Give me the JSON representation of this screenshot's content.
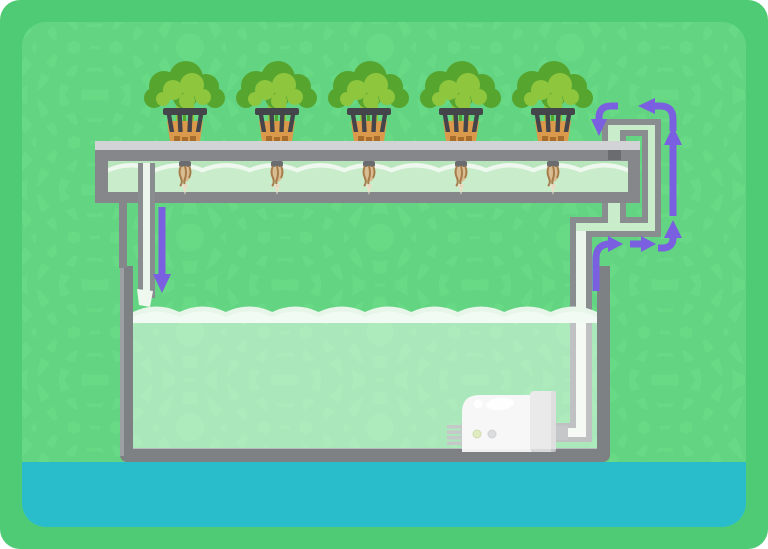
{
  "diagram": {
    "kind": "hydroponics-recirculating-system",
    "plant_count": 5,
    "components": [
      "grow-channel-with-plants",
      "net-pot-plants",
      "channel-drain-pipe",
      "reservoir-tank",
      "tank-nutrient-water",
      "water-pump",
      "pump-riser-pipe",
      "return-pipe-network",
      "channel-outlet-downspout",
      "ground-water-strip"
    ],
    "flow_arrows": [
      {
        "id": "drain-into-tank",
        "direction": "down"
      },
      {
        "id": "out-of-pump",
        "direction": "up-then-right"
      },
      {
        "id": "along-return-pipe",
        "direction": "right"
      },
      {
        "id": "into-riser",
        "direction": "right-then-up"
      },
      {
        "id": "up-riser",
        "direction": "up"
      },
      {
        "id": "over-the-top",
        "direction": "up-then-left"
      },
      {
        "id": "into-channel",
        "direction": "left-then-down"
      }
    ]
  },
  "colors": {
    "frame_green": "#4ecb74",
    "panel_green": "#68da85",
    "pattern_green": "#5ed07e",
    "ground_teal": "#29bcca",
    "tank_gray": "#7e8184",
    "tank_gray_light": "#9ca0a2",
    "channel_gray_dark": "#85878a",
    "channel_gray_light": "#d2d3d5",
    "pipe_wall": "#8a8d8f",
    "pipe_water_green": "#c9ecca",
    "pipe_water_white": "#ecf5eb",
    "channel_water_deep": "#b9e5bd",
    "wave_white": "#eef8ee",
    "tank_water_crest": "#e8f6ea",
    "purple": "#7a5fe0",
    "leaf_dark": "#56a52f",
    "leaf_light": "#8ec63e",
    "pot_orange": "#db9a4b",
    "pot_orange_dark": "#a76d2d",
    "net_pot_dark": "#44454b",
    "root_tan": "#a87c4a",
    "root_fill": "#d8bd92",
    "root_tip": "#ecdfc9",
    "pump_white": "#f0f1f0",
    "pump_gray": "#d8d9da",
    "pump_gray_dark": "#c2c3c5",
    "pump_vent": "#96989b",
    "pump_dot_green": "#c6db8e",
    "pump_dot_gray": "#bfc0c2",
    "notch_dark": "#6a6c6f",
    "white": "#ffffff"
  }
}
